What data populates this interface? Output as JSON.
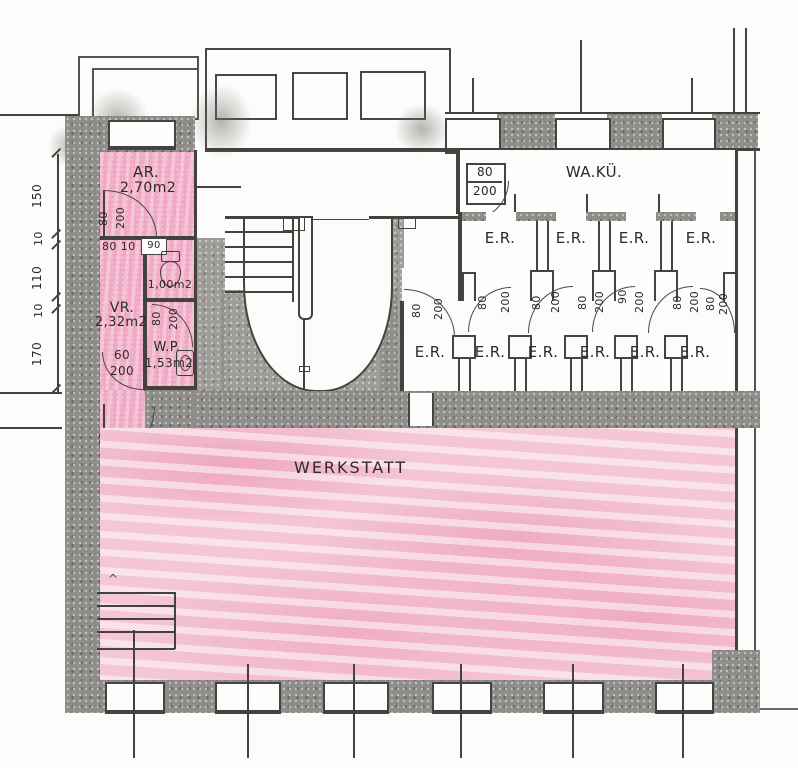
{
  "colors": {
    "pink_room": "#efa7c3",
    "pink_werkstatt": "#f4c6d6",
    "wall_grey": "#8f8d8a",
    "line": "#44423f",
    "paper": "#fcfcfa"
  },
  "labels": {
    "ar_name": "AR.",
    "ar_area": "2,70m2",
    "wc_area": "1,00m2",
    "wc_door_width": "90",
    "ar_wall_dim": "80 10",
    "vr_name": "VR.",
    "vr_area": "2,32m2",
    "wp_name": "W.P.",
    "wp_area": "1,53m2",
    "waku_name": "WA.KÜ.",
    "werkstatt_name": "WERKSTATT"
  },
  "dims": {
    "left_chain": [
      "150",
      "10",
      "110",
      "10",
      "170"
    ],
    "ar_door": [
      "80",
      "200"
    ],
    "wp_door": [
      "80",
      "200"
    ],
    "vr_door": [
      "60",
      "200"
    ],
    "werkstatt_door": [
      "80",
      "200"
    ],
    "waku_door": [
      "80",
      "200"
    ],
    "corridor_doors": [
      [
        "80",
        "200"
      ],
      [
        "80",
        "200"
      ],
      [
        "80",
        "200"
      ],
      [
        "80",
        "200"
      ],
      [
        "90",
        "200"
      ],
      [
        "80",
        "200"
      ],
      [
        "80",
        "200"
      ]
    ]
  },
  "er": {
    "row1": [
      "E.R.",
      "E.R.",
      "E.R.",
      "E.R."
    ],
    "row2": [
      "E.R.",
      "E.R.",
      "E.R.",
      "E.R.",
      "E.R.",
      "E.R."
    ]
  }
}
